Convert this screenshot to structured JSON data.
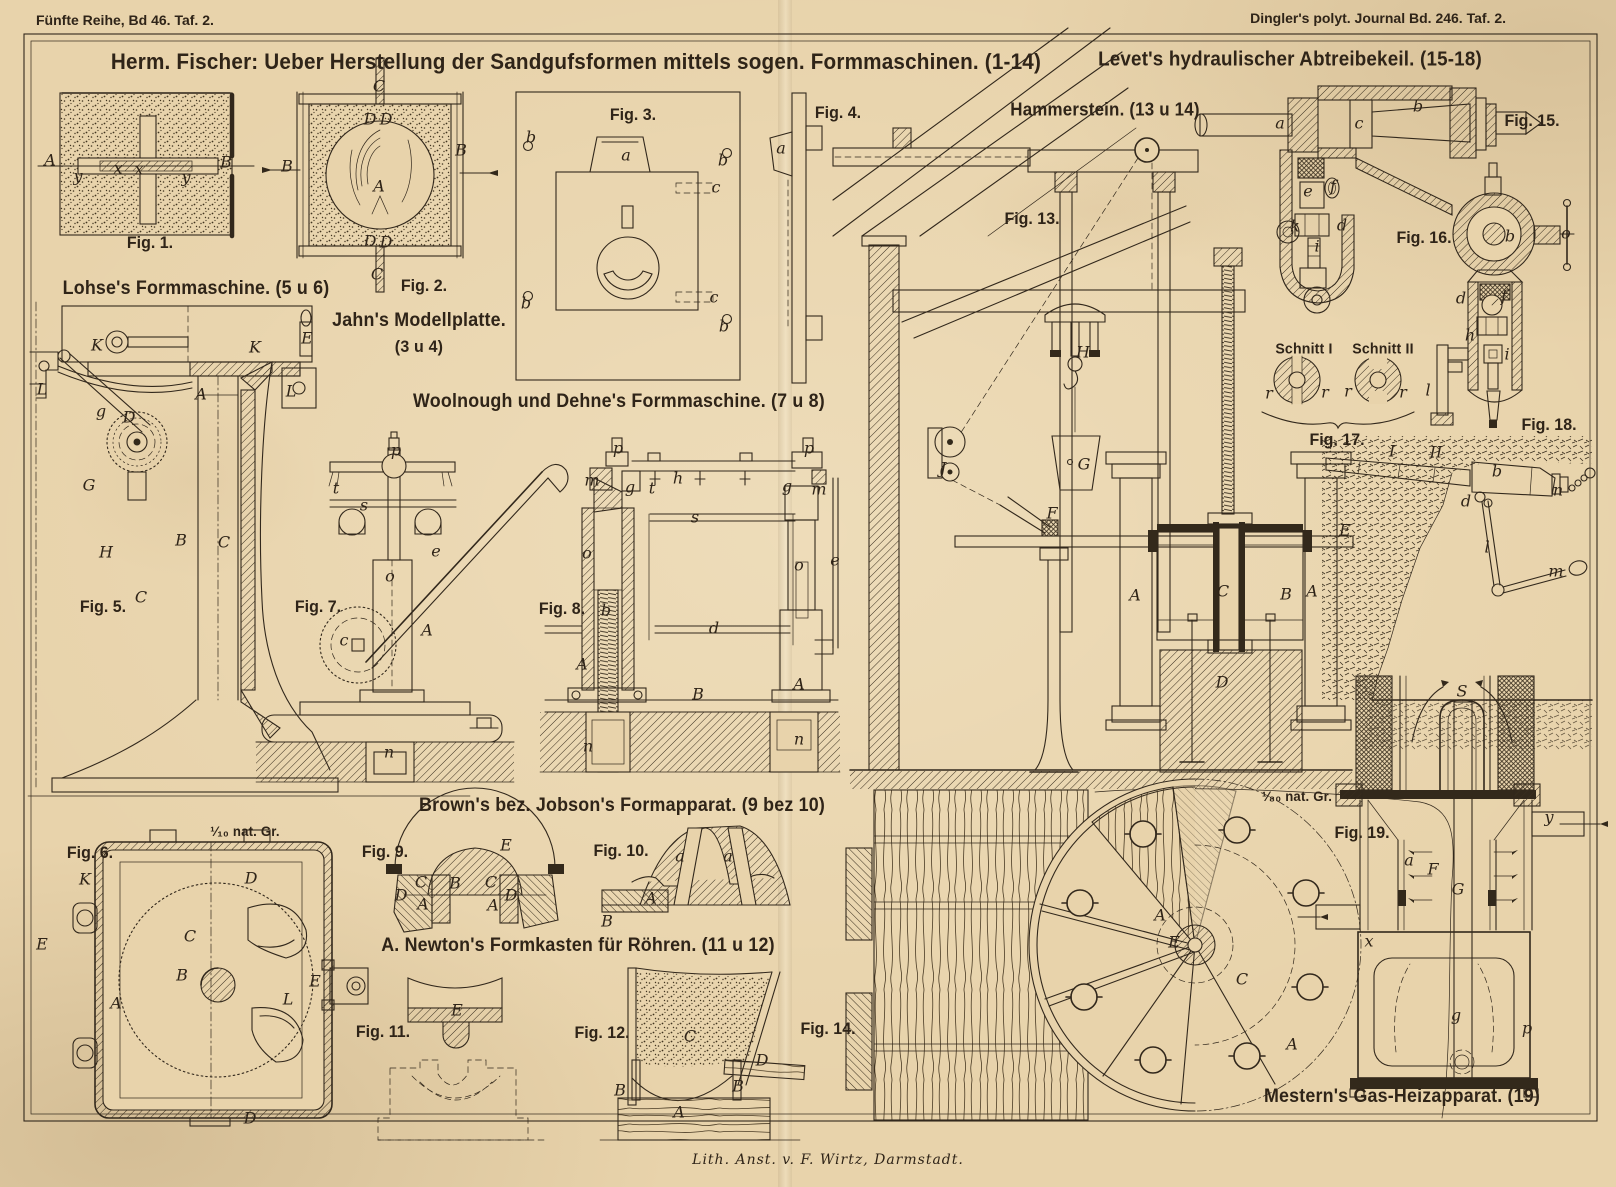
{
  "page": {
    "header_left": "Fünfte Reihe, Bd 46. Taf. 2.",
    "header_right": "Dingler's polyt. Journal Bd. 246. Taf. 2.",
    "footer": "Lith. Anst. v. F. Wirtz, Darmstadt.",
    "paper_color": "#e8d3ab",
    "ink_color": "#32281c"
  },
  "section_titles": [
    {
      "name": "title-main",
      "text": "Herm. Fischer: Ueber Herstellung der Sandgufsformen mittels sogen. Formmaschinen. (1-14)",
      "x": 576,
      "y": 62,
      "size": 22
    },
    {
      "name": "title-levet",
      "text": "Levet's hydraulischer Abtreibekeil. (15-18)",
      "x": 1290,
      "y": 60,
      "size": 20
    },
    {
      "name": "title-lohse",
      "text": "Lohse's Formmaschine. (5 u 6)",
      "x": 196,
      "y": 289,
      "size": 19
    },
    {
      "name": "title-jahn",
      "text": "Jahn's Modellplatte.",
      "x": 419,
      "y": 321,
      "size": 19
    },
    {
      "name": "title-jahn-figs",
      "text": "(3 u 4)",
      "x": 419,
      "y": 347,
      "size": 17
    },
    {
      "name": "title-woolnough",
      "text": "Woolnough und Dehne's Formmaschine. (7 u 8)",
      "x": 619,
      "y": 402,
      "size": 19
    },
    {
      "name": "title-hammerstein",
      "text": "Hammerstein. (13 u 14)",
      "x": 1105,
      "y": 110,
      "size": 18
    },
    {
      "name": "title-brown",
      "text": "Brown's bez. Jobson's Formapparat. (9 bez 10)",
      "x": 622,
      "y": 806,
      "size": 19
    },
    {
      "name": "title-newton",
      "text": "A. Newton's Formkasten für Röhren. (11 u 12)",
      "x": 578,
      "y": 946,
      "size": 19
    },
    {
      "name": "title-mestern",
      "text": "Mestern's Gas-Heizapparat. (19)",
      "x": 1402,
      "y": 1097,
      "size": 19
    },
    {
      "name": "label-schnitt-1",
      "text": "Schnitt I",
      "x": 1304,
      "y": 349,
      "size": 15
    },
    {
      "name": "label-schnitt-2",
      "text": "Schnitt II",
      "x": 1383,
      "y": 349,
      "size": 15
    },
    {
      "name": "label-scale-10",
      "text": "¹⁄₁₀ nat. Gr.",
      "x": 245,
      "y": 831,
      "size": 14
    },
    {
      "name": "label-scale-80",
      "text": "¹⁄₈₀ nat. Gr.",
      "x": 1297,
      "y": 796,
      "size": 14
    }
  ],
  "fig_labels": [
    {
      "text": "Fig. 1.",
      "x": 150,
      "y": 243
    },
    {
      "text": "Fig. 2.",
      "x": 424,
      "y": 286
    },
    {
      "text": "Fig. 3.",
      "x": 633,
      "y": 115
    },
    {
      "text": "Fig. 4.",
      "x": 838,
      "y": 113
    },
    {
      "text": "Fig. 5.",
      "x": 103,
      "y": 607
    },
    {
      "text": "Fig. 6.",
      "x": 90,
      "y": 853
    },
    {
      "text": "Fig. 7.",
      "x": 318,
      "y": 607
    },
    {
      "text": "Fig. 8.",
      "x": 562,
      "y": 609
    },
    {
      "text": "Fig. 9.",
      "x": 385,
      "y": 852
    },
    {
      "text": "Fig. 10.",
      "x": 621,
      "y": 851
    },
    {
      "text": "Fig. 11.",
      "x": 383,
      "y": 1032
    },
    {
      "text": "Fig. 12.",
      "x": 602,
      "y": 1033
    },
    {
      "text": "Fig. 13.",
      "x": 1032,
      "y": 219
    },
    {
      "text": "Fig. 14.",
      "x": 828,
      "y": 1029
    },
    {
      "text": "Fig. 15.",
      "x": 1532,
      "y": 121
    },
    {
      "text": "Fig. 16.",
      "x": 1424,
      "y": 238
    },
    {
      "text": "Fig. 17.",
      "x": 1337,
      "y": 440
    },
    {
      "text": "Fig. 18.",
      "x": 1549,
      "y": 425
    },
    {
      "text": "Fig. 19.",
      "x": 1362,
      "y": 833
    }
  ],
  "part_labels": [
    {
      "text": "A",
      "x": 50,
      "y": 160
    },
    {
      "text": "B",
      "x": 226,
      "y": 162
    },
    {
      "text": "y",
      "x": 78,
      "y": 176
    },
    {
      "text": "x",
      "x": 118,
      "y": 168
    },
    {
      "text": "x",
      "x": 139,
      "y": 169
    },
    {
      "text": "y",
      "x": 186,
      "y": 177
    },
    {
      "text": "C",
      "x": 379,
      "y": 86
    },
    {
      "text": "D",
      "x": 370,
      "y": 119
    },
    {
      "text": "D",
      "x": 386,
      "y": 119
    },
    {
      "text": "B",
      "x": 287,
      "y": 166
    },
    {
      "text": "A",
      "x": 379,
      "y": 186
    },
    {
      "text": "B",
      "x": 461,
      "y": 150
    },
    {
      "text": "D",
      "x": 370,
      "y": 241
    },
    {
      "text": "D",
      "x": 386,
      "y": 242
    },
    {
      "text": "C",
      "x": 377,
      "y": 274
    },
    {
      "text": "b",
      "x": 531,
      "y": 137
    },
    {
      "text": "a",
      "x": 626,
      "y": 155
    },
    {
      "text": "b",
      "x": 723,
      "y": 160
    },
    {
      "text": "c",
      "x": 716,
      "y": 187
    },
    {
      "text": "c",
      "x": 714,
      "y": 297
    },
    {
      "text": "b",
      "x": 526,
      "y": 303
    },
    {
      "text": "b",
      "x": 724,
      "y": 326
    },
    {
      "text": "a",
      "x": 781,
      "y": 148
    },
    {
      "text": "K",
      "x": 97,
      "y": 345
    },
    {
      "text": "K",
      "x": 255,
      "y": 347
    },
    {
      "text": "E",
      "x": 307,
      "y": 338
    },
    {
      "text": "L",
      "x": 42,
      "y": 389
    },
    {
      "text": "A",
      "x": 201,
      "y": 394
    },
    {
      "text": "L",
      "x": 291,
      "y": 391
    },
    {
      "text": "g",
      "x": 101,
      "y": 411
    },
    {
      "text": "D",
      "x": 129,
      "y": 417
    },
    {
      "text": "G",
      "x": 89,
      "y": 485
    },
    {
      "text": "H",
      "x": 106,
      "y": 552
    },
    {
      "text": "B",
      "x": 181,
      "y": 540
    },
    {
      "text": "C",
      "x": 224,
      "y": 542
    },
    {
      "text": "C",
      "x": 141,
      "y": 597
    },
    {
      "text": "K",
      "x": 85,
      "y": 879
    },
    {
      "text": "D",
      "x": 251,
      "y": 878
    },
    {
      "text": "E",
      "x": 42,
      "y": 944
    },
    {
      "text": "C",
      "x": 190,
      "y": 936
    },
    {
      "text": "B",
      "x": 182,
      "y": 975
    },
    {
      "text": "A",
      "x": 116,
      "y": 1003
    },
    {
      "text": "E",
      "x": 315,
      "y": 981
    },
    {
      "text": "L",
      "x": 288,
      "y": 999
    },
    {
      "text": "D",
      "x": 250,
      "y": 1118
    },
    {
      "text": "p",
      "x": 396,
      "y": 450
    },
    {
      "text": "t",
      "x": 336,
      "y": 488
    },
    {
      "text": "s",
      "x": 364,
      "y": 505
    },
    {
      "text": "e",
      "x": 436,
      "y": 551
    },
    {
      "text": "o",
      "x": 390,
      "y": 576
    },
    {
      "text": "A",
      "x": 427,
      "y": 630
    },
    {
      "text": "c",
      "x": 344,
      "y": 640
    },
    {
      "text": "n",
      "x": 389,
      "y": 752
    },
    {
      "text": "p",
      "x": 618,
      "y": 448
    },
    {
      "text": "m",
      "x": 592,
      "y": 480
    },
    {
      "text": "g",
      "x": 630,
      "y": 487
    },
    {
      "text": "t",
      "x": 652,
      "y": 488
    },
    {
      "text": "h",
      "x": 678,
      "y": 478
    },
    {
      "text": "s",
      "x": 695,
      "y": 517
    },
    {
      "text": "o",
      "x": 587,
      "y": 553
    },
    {
      "text": "b",
      "x": 606,
      "y": 610
    },
    {
      "text": "d",
      "x": 714,
      "y": 628
    },
    {
      "text": "A",
      "x": 582,
      "y": 664
    },
    {
      "text": "B",
      "x": 698,
      "y": 694
    },
    {
      "text": "n",
      "x": 588,
      "y": 746
    },
    {
      "text": "p",
      "x": 809,
      "y": 448
    },
    {
      "text": "g",
      "x": 787,
      "y": 486
    },
    {
      "text": "m",
      "x": 819,
      "y": 489
    },
    {
      "text": "o",
      "x": 799,
      "y": 565
    },
    {
      "text": "e",
      "x": 835,
      "y": 560
    },
    {
      "text": "A",
      "x": 799,
      "y": 684
    },
    {
      "text": "n",
      "x": 799,
      "y": 739
    },
    {
      "text": "E",
      "x": 506,
      "y": 845
    },
    {
      "text": "C",
      "x": 421,
      "y": 882
    },
    {
      "text": "B",
      "x": 455,
      "y": 883
    },
    {
      "text": "C",
      "x": 491,
      "y": 882
    },
    {
      "text": "D",
      "x": 401,
      "y": 895
    },
    {
      "text": "A",
      "x": 423,
      "y": 904
    },
    {
      "text": "A",
      "x": 493,
      "y": 905
    },
    {
      "text": "D",
      "x": 511,
      "y": 895
    },
    {
      "text": "a",
      "x": 680,
      "y": 856
    },
    {
      "text": "a",
      "x": 728,
      "y": 856
    },
    {
      "text": "A",
      "x": 651,
      "y": 898
    },
    {
      "text": "B",
      "x": 607,
      "y": 921
    },
    {
      "text": "E",
      "x": 457,
      "y": 1010
    },
    {
      "text": "C",
      "x": 690,
      "y": 1036
    },
    {
      "text": "D",
      "x": 762,
      "y": 1060
    },
    {
      "text": "B",
      "x": 620,
      "y": 1090
    },
    {
      "text": "B",
      "x": 738,
      "y": 1086
    },
    {
      "text": "A",
      "x": 679,
      "y": 1112
    },
    {
      "text": "J",
      "x": 943,
      "y": 468
    },
    {
      "text": "H",
      "x": 1083,
      "y": 352
    },
    {
      "text": "G",
      "x": 1084,
      "y": 464
    },
    {
      "text": "F",
      "x": 1052,
      "y": 513
    },
    {
      "text": "A",
      "x": 1135,
      "y": 595
    },
    {
      "text": "C",
      "x": 1223,
      "y": 591
    },
    {
      "text": "B",
      "x": 1286,
      "y": 594
    },
    {
      "text": "A",
      "x": 1312,
      "y": 591
    },
    {
      "text": "E",
      "x": 1345,
      "y": 530
    },
    {
      "text": "D",
      "x": 1222,
      "y": 682
    },
    {
      "text": "A",
      "x": 1160,
      "y": 915
    },
    {
      "text": "E",
      "x": 1174,
      "y": 942
    },
    {
      "text": "C",
      "x": 1242,
      "y": 979
    },
    {
      "text": "A",
      "x": 1292,
      "y": 1044
    },
    {
      "text": "a",
      "x": 1280,
      "y": 123
    },
    {
      "text": "c",
      "x": 1359,
      "y": 123
    },
    {
      "text": "b",
      "x": 1418,
      "y": 106
    },
    {
      "text": "e",
      "x": 1308,
      "y": 191
    },
    {
      "text": "f",
      "x": 1333,
      "y": 186
    },
    {
      "text": "k",
      "x": 1295,
      "y": 226
    },
    {
      "text": "i",
      "x": 1317,
      "y": 246
    },
    {
      "text": "d",
      "x": 1342,
      "y": 225
    },
    {
      "text": "b",
      "x": 1510,
      "y": 236
    },
    {
      "text": "o",
      "x": 1566,
      "y": 233
    },
    {
      "text": "d",
      "x": 1461,
      "y": 298
    },
    {
      "text": "f",
      "x": 1504,
      "y": 296
    },
    {
      "text": "h",
      "x": 1470,
      "y": 335
    },
    {
      "text": "i",
      "x": 1507,
      "y": 354
    },
    {
      "text": "l",
      "x": 1428,
      "y": 390
    },
    {
      "text": "r",
      "x": 1269,
      "y": 393
    },
    {
      "text": "r",
      "x": 1325,
      "y": 392
    },
    {
      "text": "r",
      "x": 1348,
      "y": 391
    },
    {
      "text": "r",
      "x": 1403,
      "y": 392
    },
    {
      "text": "I",
      "x": 1392,
      "y": 451
    },
    {
      "text": "II",
      "x": 1436,
      "y": 452
    },
    {
      "text": "b",
      "x": 1497,
      "y": 471
    },
    {
      "text": "n",
      "x": 1558,
      "y": 490
    },
    {
      "text": "d",
      "x": 1466,
      "y": 501
    },
    {
      "text": "l",
      "x": 1487,
      "y": 547
    },
    {
      "text": "m",
      "x": 1556,
      "y": 571
    },
    {
      "text": "S",
      "x": 1462,
      "y": 691
    },
    {
      "text": "y",
      "x": 1549,
      "y": 817
    },
    {
      "text": "a",
      "x": 1409,
      "y": 860
    },
    {
      "text": "F",
      "x": 1433,
      "y": 869
    },
    {
      "text": "G",
      "x": 1458,
      "y": 889
    },
    {
      "text": "x",
      "x": 1369,
      "y": 941
    },
    {
      "text": "g",
      "x": 1456,
      "y": 1015
    },
    {
      "text": "p",
      "x": 1527,
      "y": 1028
    }
  ]
}
